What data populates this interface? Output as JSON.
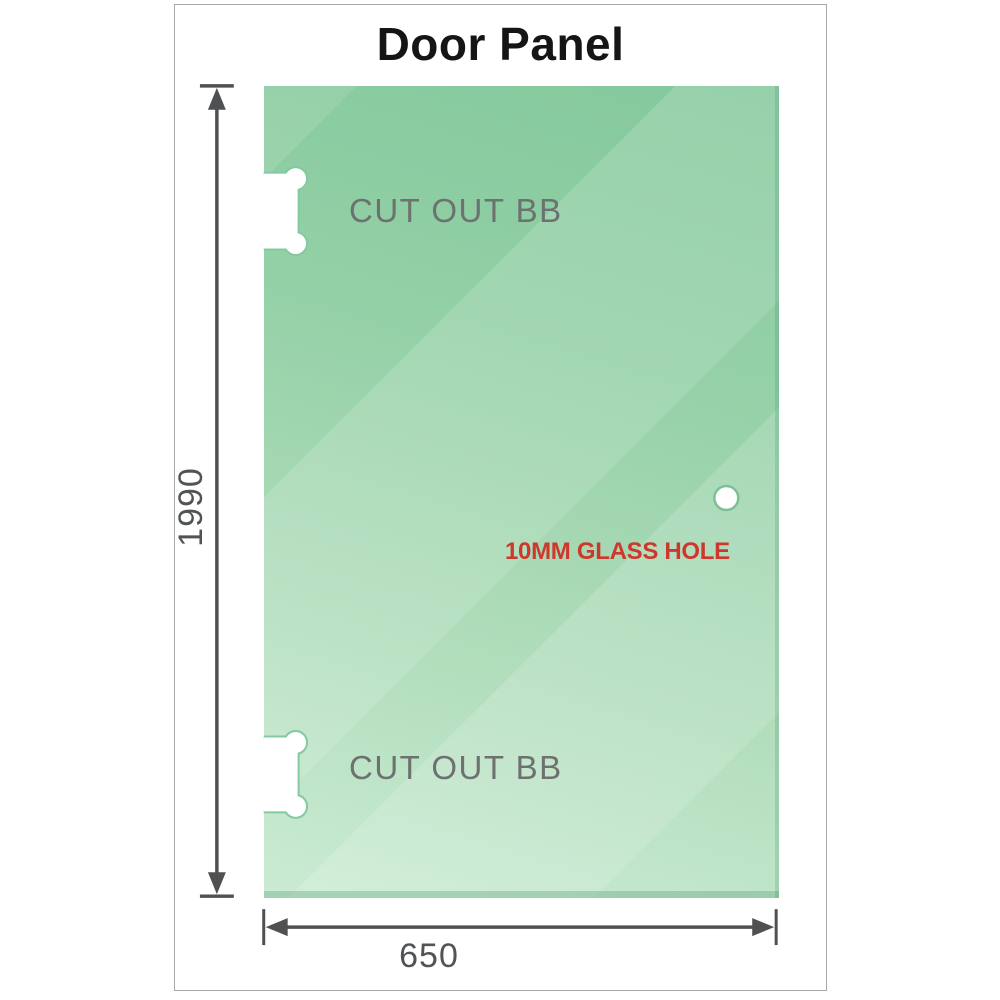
{
  "title": "Door Panel",
  "dimensions": {
    "height": "1990",
    "width": "650"
  },
  "labels": {
    "cutout_top": "CUT OUT BB",
    "cutout_bottom": "CUT OUT BB",
    "glass_hole": "10MM GLASS HOLE"
  },
  "colors": {
    "glass_green_top": "#84c89c",
    "glass_green_mid": "#aedcb9",
    "glass_green_bottom": "#c9ebd2",
    "dimension_gray": "#4e5052",
    "dimension_text_gray": "#515456",
    "cutout_text_gray": "#6d716f",
    "hole_label_red": "#ce382c",
    "frame_border_gray": "#a8a8a8"
  }
}
